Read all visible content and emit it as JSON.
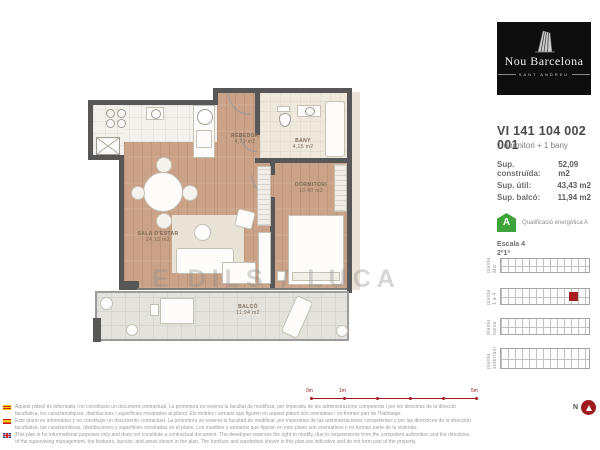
{
  "brand": {
    "name": "Nou Barcelona",
    "subtitle": "SANT ANDREU"
  },
  "unit": {
    "code": "VI 141 104 002 001",
    "type": "1 dormitori + 1 bany",
    "areas": [
      {
        "label": "Sup. construïda:",
        "value": "52,09 m2"
      },
      {
        "label": "Sup. útil:",
        "value": "43,43 m2"
      },
      {
        "label": "Sup. balcó:",
        "value": "11,94 m2"
      }
    ]
  },
  "energy": {
    "rating": "A",
    "label": "Qualificació energètica A",
    "color": "#3fa33b"
  },
  "location": {
    "escala": "Escala 4",
    "floor": "2º1ª"
  },
  "keyplans": [
    {
      "label": "planta àtic"
    },
    {
      "label": "planta 1 a 4",
      "highlight": true
    },
    {
      "label": "planta baixa"
    },
    {
      "label": "planta soterrani"
    }
  ],
  "plan": {
    "watermark": "E DILS / LUCA",
    "rooms": {
      "rebedor": {
        "name": "REBEDOR",
        "area": "4,73 m2"
      },
      "bany": {
        "name": "BANY",
        "area": "4,15 m2"
      },
      "sala": {
        "name": "SALA D'ESTAR",
        "area": "24,15 m2"
      },
      "dormitori": {
        "name": "DORMITORI",
        "area": "10,40 m2"
      },
      "balco": {
        "name": "BALCÓ",
        "area": "11,94 m2"
      }
    }
  },
  "scalebar": {
    "labels": [
      "0m",
      "1m",
      "5m"
    ],
    "color": "#9e1b20"
  },
  "north": {
    "label": "N"
  },
  "disclaimers": [
    {
      "flag": "catalonia-flag",
      "text": "Aquest plànol és informatiu i no constitueix un document contractual. La promotora es reserva la facultat de modificar, per imperatiu de les administracions competents i per les directrius de la direcció facultativa, les característiques, distribucions i superfícies mostrades al plànol. Els mobles i armaris que figuren en aquest plànol són orientatius i no formen part de l'habitatge."
    },
    {
      "flag": "spain-flag",
      "text": "Este plano es informativo y no constituye un documento contractual. La promotora se reserva la facultad de modificar, por imperativo de las administraciones competentes y por las directrices de la dirección facultativa, las características, distribuciones y superficies mostradas en el plano. Los muebles y armarios que figuran en este plano son orientativos y no forman parte de la vivienda."
    },
    {
      "flag": "uk-flag",
      "text": "This plan is for informational purposes only and does not constitute a contractual document. The developer reserves the right to modify, due to requirements from the competent authorities and the directives of the supervising management, the features, layouts, and areas shown in the plan. The furniture and wardrobes shown in this plan are indicative and do not form part of the property."
    }
  ]
}
